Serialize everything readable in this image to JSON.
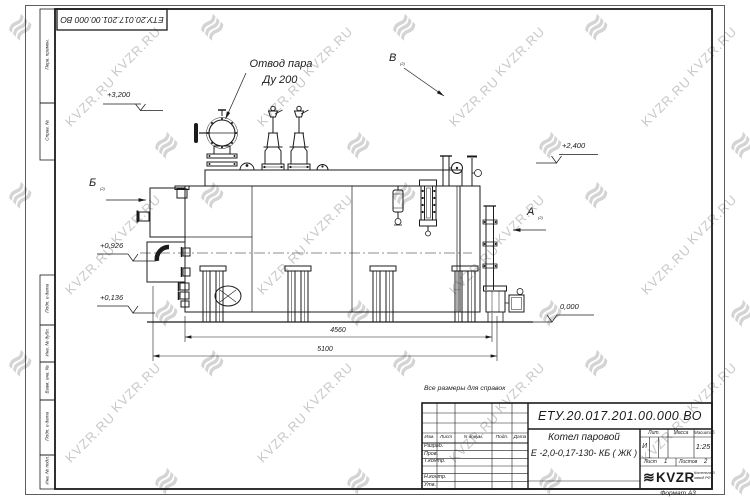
{
  "sheet": {
    "watermark_text": "KVZR.RU",
    "watermark_glyph": "≋",
    "format_note": "Формат А3",
    "top_stamp_number": "ЕТУ.20.017.201.00.000  ВО"
  },
  "margin_labels": [
    "Перв. примен.",
    "Справ. №",
    "Подп. и дата",
    "Инв. № дубл.",
    "Взам. инв. №",
    "Подп. и дата",
    "Инв. № подл."
  ],
  "annotations": {
    "steam_outlet_line1": "Отвод пара",
    "steam_outlet_line2": "Ду 200",
    "reference_note": "Все размеры для справок",
    "view_a": "А",
    "view_b": "Б",
    "view_v": "В",
    "view_sheet_ref": "(2)",
    "elevations": [
      "+3,200",
      "+2,400",
      "+0,926",
      "+0,136",
      "0,000"
    ],
    "dimensions": [
      "4560",
      "5100"
    ]
  },
  "title_block": {
    "doc_number": "ЕТУ.20.017.201.00.000  ВО",
    "product_line1": "Котел паровой",
    "product_line2": "Е -2,0-0,17-130- КБ ( ЖК )",
    "header_cols": [
      "Изм.",
      "Лист",
      "N докум.",
      "Подп.",
      "Дата"
    ],
    "sign_rows": [
      "Разраб.",
      "Пров.",
      "Т.контр.",
      "Н.контр.",
      "Утв."
    ],
    "lit_label": "Лит.",
    "mass_label": "Масса",
    "scale_label": "Масштаб",
    "lit_value": "И",
    "scale_value": "1:25",
    "sheet_label": "Лист",
    "sheet_value": "1",
    "sheets_label": "Листов",
    "sheets_value": "2",
    "logo_glyph": "≋",
    "logo_text": "KVZR",
    "logo_sub1": "Котельный",
    "logo_sub2": "завод РФ"
  }
}
